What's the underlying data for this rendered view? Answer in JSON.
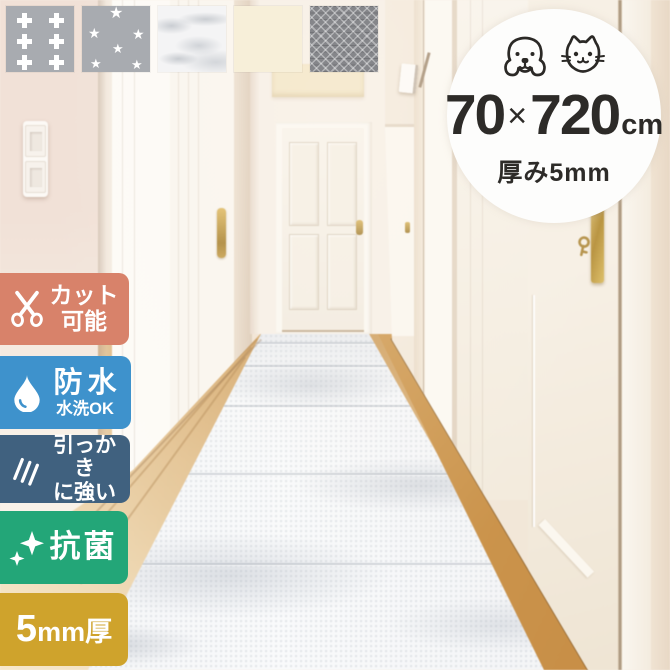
{
  "image_type": "product-promotional-image",
  "swatches": [
    {
      "name": "gray-cross-pattern"
    },
    {
      "name": "gray-star-pattern"
    },
    {
      "name": "white-marble-pattern"
    },
    {
      "name": "plain-cream"
    },
    {
      "name": "gray-ornate-pattern"
    }
  ],
  "size_circle": {
    "pets": [
      "dog",
      "cat"
    ],
    "width": "70",
    "times": "×",
    "length": "720",
    "unit": "cm",
    "thickness": "厚み5mm"
  },
  "badges": [
    {
      "id": "cuttable",
      "icon": "scissors-icon",
      "lines": [
        "カット",
        "可能"
      ],
      "color": "#d8826a"
    },
    {
      "id": "waterproof",
      "icon": "water-drop-icon",
      "lines": [
        "防水",
        "水洗OK"
      ],
      "color": "#3e92cc"
    },
    {
      "id": "scratch-resistant",
      "icon": "scratch-icon",
      "lines": [
        "引っかき",
        "に強い"
      ],
      "color": "#40617f"
    },
    {
      "id": "antibacterial",
      "icon": "sparkle-icon",
      "lines": [
        "抗菌"
      ],
      "color": "#23a678"
    },
    {
      "id": "thickness",
      "icon": null,
      "parts": {
        "value": "5",
        "unit": "mm",
        "suffix": "厚"
      },
      "color": "#cfa32c"
    }
  ],
  "colors": {
    "text_dark": "#2d2b28",
    "wall_cream": "#f5ecdf",
    "wall_pink": "#f1e1d7",
    "wood_floor": "#ddb27a",
    "mat_white": "#f6f7f9",
    "brass": "#c9a551"
  }
}
